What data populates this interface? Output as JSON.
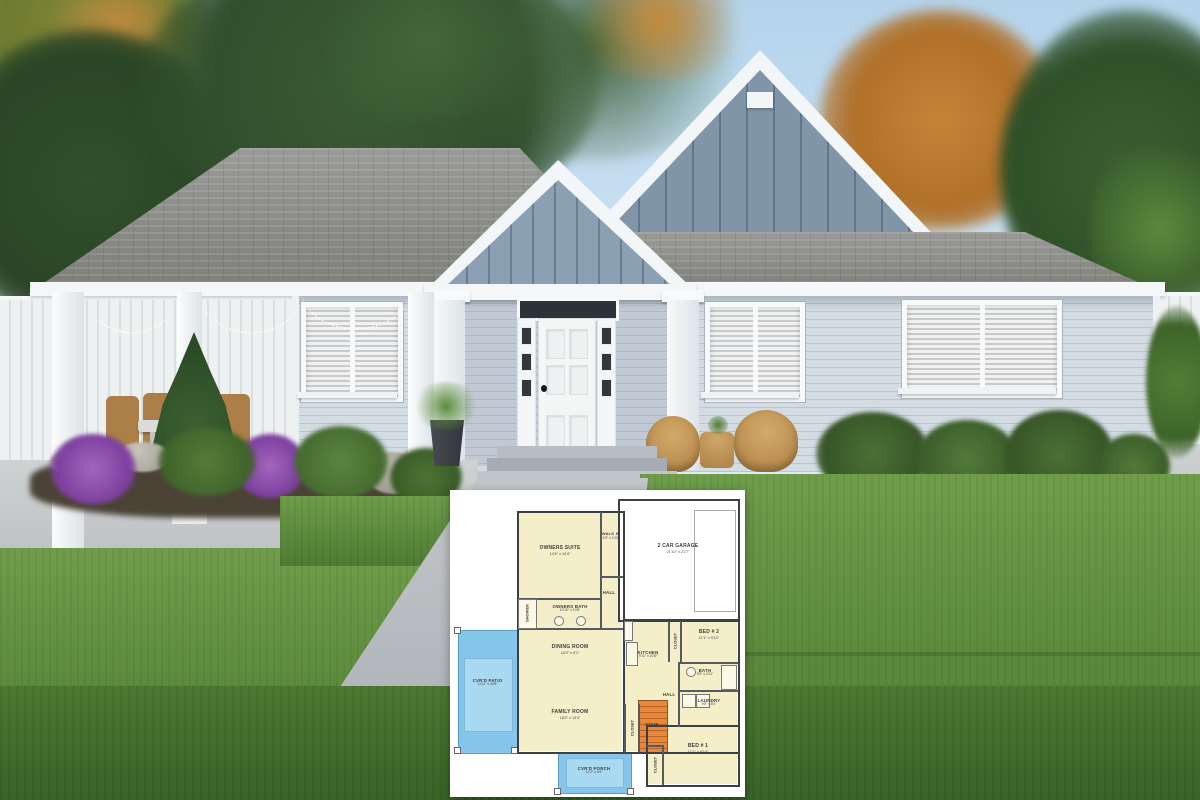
{
  "scene_title": "Craftsman ranch house exterior rendering with floor plan inset",
  "colors": {
    "sky": "#bcd9ee",
    "siding": "#ccd4dd",
    "gable_siding": "#8095a8",
    "roof_shingle": "#8d8d8b",
    "trim_white": "#f5f7f8",
    "lawn_green": "#5a8a3c",
    "plan_room_fill": "#f4eec9",
    "plan_outdoor_fill": "#84c5e9",
    "plan_stair_fill": "#e8873a"
  },
  "floor_plan": {
    "rooms": [
      {
        "name": "OWNERS SUITE",
        "dims": "14'4\" x 14'4\""
      },
      {
        "name": "WALK IN",
        "dims": "4'9\" x 10'5\""
      },
      {
        "name": "2 CAR GARAGE",
        "dims": "21'10\" x 21'7\""
      },
      {
        "name": "OWNERS BATH",
        "dims": "10'10\" x 10'8\""
      },
      {
        "name": "DINING ROOM",
        "dims": "18'3\" x 9'1\""
      },
      {
        "name": "KITCHEN",
        "dims": "9'11\" x 16'8\""
      },
      {
        "name": "BED # 2",
        "dims": "11'1\" x 9'10\""
      },
      {
        "name": "BATH",
        "dims": "9'9\" x 4'11\""
      },
      {
        "name": "LAUNDRY",
        "dims": "9'6\" x 8'4\""
      },
      {
        "name": "FAMILY ROOM",
        "dims": "18'3\" x 13'4\""
      },
      {
        "name": "BED # 1",
        "dims": "11'1\" x 9'10\""
      },
      {
        "name": "CVR'D PATIO",
        "dims": "11'11\" x 23'8\""
      },
      {
        "name": "CVR'D PORCH",
        "dims": "12'2\" x 5'4\""
      }
    ],
    "labels": {
      "hall": "HALL",
      "shower": "SHOWER",
      "stair": "STAIR",
      "closet": "CLOSET"
    }
  }
}
